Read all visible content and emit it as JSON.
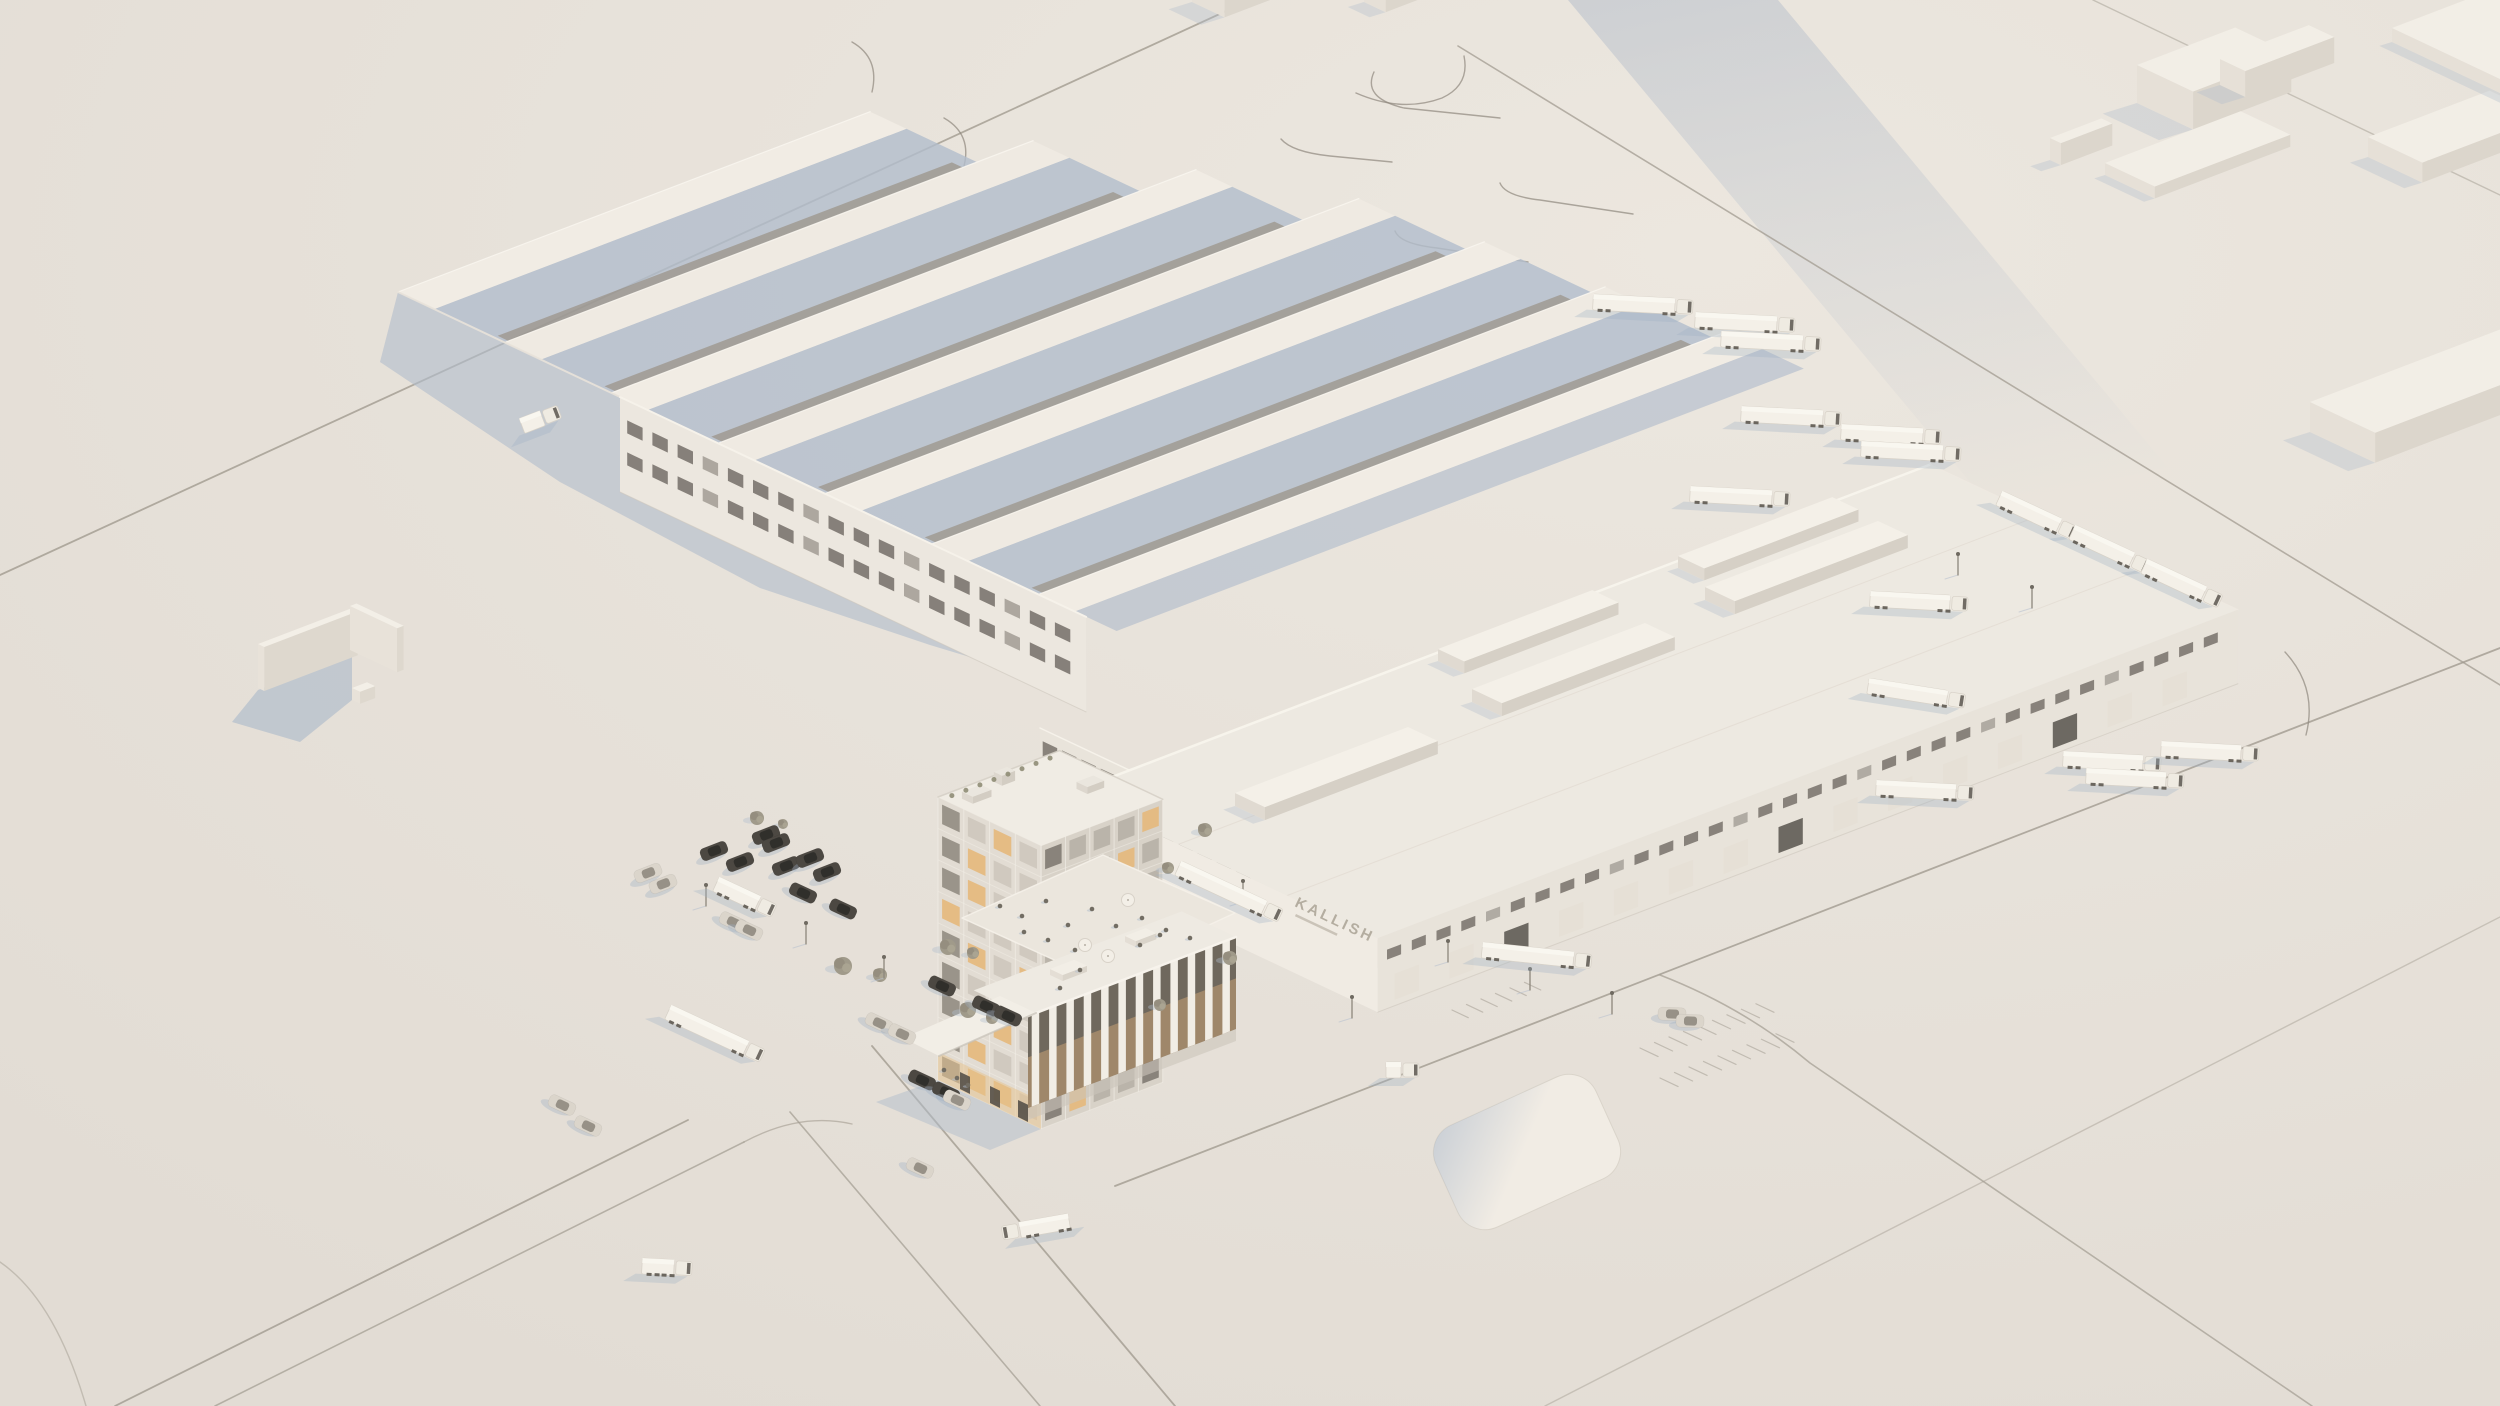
{
  "scene": {
    "signage": {
      "wall_text": "KALLISH"
    },
    "colors": {
      "ground_hi": "#ece7df",
      "ground_lo": "#e2dcd4",
      "roof_light": "#f1ece4",
      "roof_alt": "#efeae2",
      "roof_c": "#edE9e1",
      "face_light": "#efeae1",
      "face_mid": "#e6e0d7",
      "face_dark": "#dcd6cc",
      "shadow_blue": "#b2bdcc",
      "shadow_soft": "#c9c3b9",
      "window_dark": "#6d6760",
      "window_band": "#8f8471",
      "window_warm": "#e5b97f",
      "road": "#a19b90",
      "truck_white": "#f4f0e8",
      "car_dark": "#4c4842",
      "car_light": "#dbd5cb",
      "tree": "#a09a8a",
      "glow": "#e6c28c",
      "sign": "#b1aa9d"
    },
    "roads": [
      {
        "d": "M0,575 L1250,0",
        "w": 1.8,
        "o": 0.8
      },
      {
        "d": "M115,1406 L688,1120",
        "w": 1.8,
        "o": 0.8
      },
      {
        "d": "M215,1406 L744,1142",
        "w": 1.6,
        "o": 0.7
      },
      {
        "d": "M872,1046 L1175,1406",
        "w": 1.8,
        "o": 0.8
      },
      {
        "d": "M790,1112 L1040,1406",
        "w": 1.6,
        "o": 0.7
      },
      {
        "d": "M1115,1186 L2500,648",
        "w": 1.8,
        "o": 0.8
      },
      {
        "d": "M1545,1406 L2500,917",
        "w": 1.4,
        "o": 0.45
      },
      {
        "d": "M1660,975 Q1745,1008 1810,1063 L2312,1406",
        "w": 1.6,
        "o": 0.7
      },
      {
        "d": "M1458,46 L2500,685",
        "w": 1.6,
        "o": 0.75
      },
      {
        "d": "M2093,0 L2500,195",
        "w": 1.4,
        "o": 0.5
      },
      {
        "d": "M744,1142 Q800,1112 852,1124",
        "w": 1.4,
        "o": 0.6
      },
      {
        "d": "M0,1262 Q55,1300 86,1406",
        "w": 1.4,
        "o": 0.5
      }
    ],
    "lane_curves": [
      "M1374,72 Q1362,98 1404,108 L1500,118",
      "M1281,139 Q1292,152 1330,156 L1392,162",
      "M1500,183 Q1505,196 1540,200 L1633,214",
      "M1395,231 Q1400,244 1437,248 L1528,262",
      "M1637,297 Q1642,306 1676,312",
      "M1356,93 Q1402,113 1442,98 Q1470,85 1464,56",
      "M2285,652 Q2318,688 2306,735",
      "M852,42 Q880,58 872,92",
      "M944,118 Q972,134 964,166"
    ],
    "band_shadow": [
      [
        1568,
        0
      ],
      [
        1778,
        0
      ],
      [
        2245,
        560
      ],
      [
        2035,
        560
      ]
    ],
    "ground_shadows": [
      {
        "pts": [
          [
            398,
            292
          ],
          [
            1086,
            617
          ],
          [
            1086,
            692
          ],
          [
            930,
            645
          ],
          [
            760,
            588
          ],
          [
            560,
            482
          ],
          [
            380,
            362
          ]
        ],
        "c": "blue",
        "o": 0.62
      },
      {
        "pts": [
          [
            1070,
            795
          ],
          [
            1378,
            940
          ],
          [
            1378,
            968
          ],
          [
            1070,
            823
          ]
        ],
        "c": "soft",
        "o": 0.5
      }
    ],
    "stall_groups": [
      {
        "o": [
          1640,
          1048
        ],
        "n": 9,
        "step": 15.5,
        "len": 20
      },
      {
        "o": [
          1660,
          1078
        ],
        "n": 9,
        "step": 15.5,
        "len": 20
      },
      {
        "o": [
          1452,
          1010
        ],
        "n": 6,
        "step": 15.5,
        "len": 18
      }
    ],
    "pad": {
      "cx": 1527,
      "cy": 1152,
      "w": 176,
      "h": 112,
      "rx": 30,
      "rot": -24.5
    },
    "monitor_bars": {
      "origin": [
        398,
        292
      ],
      "vstep": 118,
      "count": 7,
      "width": 40,
      "band": 12,
      "lengths": [
        505,
        565,
        625,
        685,
        705,
        720,
        735
      ]
    },
    "warehouse_b": {
      "facade": {
        "origin": [
          620,
          397
        ],
        "vlen": 515,
        "h": 95,
        "win_rows": [
          20,
          52
        ],
        "win_n": 18,
        "win_step": 27.8
      }
    },
    "mid_hall": {
      "origin": [
        1040,
        728
      ],
      "vlen": 235,
      "h": 88,
      "roof_depth": 45,
      "win_n": 11
    },
    "warehouse_c": {
      "w": [
        1070,
        793
      ],
      "ulen": 920,
      "vlen": 340,
      "facade_h": 74,
      "ridge_offsets": [
        120,
        240
      ],
      "skylights": [
        {
          "o": [
            1235,
            806
          ],
          "lu": 185,
          "lv": 33,
          "h": 13
        },
        {
          "o": [
            1472,
            702
          ],
          "lu": 185,
          "lv": 33,
          "h": 13
        },
        {
          "o": [
            1705,
            600
          ],
          "lu": 185,
          "lv": 33,
          "h": 13
        },
        {
          "o": [
            1438,
            661
          ],
          "lu": 165,
          "lv": 29,
          "h": 12
        },
        {
          "o": [
            1678,
            568
          ],
          "lu": 165,
          "lv": 29,
          "h": 12
        }
      ],
      "win_n": 34,
      "dock_n": 15,
      "dark_docks": [
        2,
        7,
        12
      ],
      "sign_rot": 25.2
    },
    "tower": {
      "a": [
        938,
        797
      ],
      "ulen": 130,
      "vlen": 114,
      "height": 283,
      "sw": {
        "cols": 4,
        "rows": 9,
        "lit": [
          2,
          5,
          9,
          12,
          17,
          19,
          22,
          26,
          29,
          33,
          34
        ]
      },
      "se": {
        "cols": 5,
        "rows": 9,
        "lit": [
          4,
          8,
          13,
          17,
          21,
          27,
          33,
          38,
          41
        ]
      },
      "shadow": [
        [
          938,
          1080
        ],
        [
          1041,
          1129
        ],
        [
          990,
          1150
        ],
        [
          876,
          1102
        ]
      ]
    },
    "terrace": {
      "pts": [
        [
          962,
          918
        ],
        [
          1103,
          855
        ],
        [
          1235,
          913
        ],
        [
          1094,
          978
        ]
      ]
    },
    "colonnade": {
      "a": [
        1028,
        1016
      ],
      "b": [
        1236,
        937
      ],
      "h": 92,
      "cols": 12,
      "roof_depth": 60
    },
    "canopy": {
      "pts": [
        [
          903,
          1038
        ],
        [
          1000,
          996
        ],
        [
          1036,
          1013
        ],
        [
          939,
          1056
        ]
      ]
    },
    "people": [
      [
        1000,
        906
      ],
      [
        1022,
        916
      ],
      [
        1046,
        901
      ],
      [
        1068,
        925
      ],
      [
        1092,
        909
      ],
      [
        1116,
        926
      ],
      [
        1142,
        918
      ],
      [
        1166,
        930
      ],
      [
        1190,
        938
      ],
      [
        1075,
        950
      ],
      [
        1048,
        940
      ],
      [
        1024,
        932
      ],
      [
        1080,
        970
      ],
      [
        1140,
        945
      ],
      [
        1160,
        935
      ],
      [
        1060,
        988
      ],
      [
        944,
        1070
      ],
      [
        957,
        1078
      ],
      [
        968,
        1085
      ]
    ],
    "umbrellas": [
      [
        1085,
        945
      ],
      [
        1128,
        900
      ],
      [
        1108,
        956
      ]
    ],
    "trees": [
      [
        843,
        966,
        9
      ],
      [
        880,
        975,
        7
      ],
      [
        948,
        947,
        8
      ],
      [
        973,
        953,
        6
      ],
      [
        968,
        1010,
        8
      ],
      [
        992,
        1018,
        6
      ],
      [
        757,
        818,
        7
      ],
      [
        783,
        824,
        5
      ],
      [
        1205,
        830,
        7
      ],
      [
        1168,
        868,
        6
      ],
      [
        1230,
        958,
        7
      ],
      [
        1160,
        1005,
        6
      ]
    ],
    "poles": [
      [
        706,
        906
      ],
      [
        806,
        944
      ],
      [
        884,
        978
      ],
      [
        1243,
        902
      ],
      [
        1448,
        962
      ],
      [
        1530,
        990
      ],
      [
        1612,
        1014
      ],
      [
        1958,
        575
      ],
      [
        2032,
        608
      ],
      [
        1352,
        1018
      ]
    ],
    "context_boxes": [
      [
        2137,
        103,
        105,
        62,
        38
      ],
      [
        2220,
        85,
        95,
        28,
        26
      ],
      [
        2050,
        160,
        55,
        12,
        22
      ],
      [
        2105,
        175,
        145,
        55,
        12
      ],
      [
        2368,
        157,
        130,
        60,
        20
      ],
      [
        2392,
        42,
        108,
        300,
        14
      ],
      [
        2310,
        432,
        205,
        72,
        30
      ],
      [
        1192,
        2,
        120,
        36,
        26
      ],
      [
        1364,
        2,
        72,
        24,
        18
      ]
    ],
    "left_walls": {
      "boxes": [
        [
          258,
          688,
          100,
          7,
          44
        ],
        [
          350,
          650,
          7,
          52,
          44
        ],
        [
          352,
          700,
          16,
          9,
          12
        ]
      ],
      "shadow": [
        [
          258,
          690
        ],
        [
          352,
          652
        ],
        [
          352,
          700
        ],
        [
          300,
          742
        ],
        [
          232,
          722
        ]
      ]
    },
    "trucks": [
      [
        1593,
        302,
        3,
        82,
        1
      ],
      [
        1695,
        320,
        3,
        82,
        1
      ],
      [
        1721,
        339,
        3,
        82,
        1
      ],
      [
        1741,
        414,
        3,
        82,
        1
      ],
      [
        1841,
        432,
        3,
        82,
        1
      ],
      [
        1861,
        449,
        3,
        82,
        1
      ],
      [
        1690,
        494,
        3,
        82,
        1
      ],
      [
        1870,
        599,
        3,
        80,
        1
      ],
      [
        1868,
        686,
        9,
        80,
        1
      ],
      [
        1876,
        788,
        3,
        80,
        1
      ],
      [
        2063,
        759,
        3,
        80,
        1
      ],
      [
        2086,
        776,
        3,
        80,
        1
      ],
      [
        2161,
        749,
        3,
        80,
        1
      ],
      [
        1999,
        498,
        25,
        66,
        1
      ],
      [
        2072,
        532,
        25,
        66,
        1
      ],
      [
        2144,
        566,
        25,
        66,
        1
      ],
      [
        1178,
        868,
        25,
        95,
        1
      ],
      [
        1482,
        950,
        6,
        92,
        1
      ],
      [
        1020,
        1230,
        -10,
        50,
        -1
      ],
      [
        668,
        1012,
        25,
        86,
        1
      ],
      [
        716,
        884,
        25,
        46,
        1
      ],
      [
        642,
        1266,
        3,
        32,
        1
      ],
      [
        522,
        426,
        -21,
        22,
        1
      ],
      [
        1386,
        1070,
        0,
        15,
        1
      ]
    ],
    "cars": [
      [
        714,
        851,
        -21,
        "d"
      ],
      [
        740,
        862,
        -21,
        "d"
      ],
      [
        766,
        835,
        -21,
        "d"
      ],
      [
        786,
        866,
        -21,
        "d"
      ],
      [
        810,
        858,
        -21,
        "d"
      ],
      [
        827,
        872,
        -21,
        "d"
      ],
      [
        776,
        843,
        -21,
        "d"
      ],
      [
        843,
        909,
        25,
        "d"
      ],
      [
        803,
        893,
        25,
        "d"
      ],
      [
        942,
        986,
        25,
        "d"
      ],
      [
        986,
        1006,
        25,
        "d"
      ],
      [
        1008,
        1016,
        25,
        "d"
      ],
      [
        922,
        1080,
        25,
        "d"
      ],
      [
        946,
        1092,
        25,
        "d"
      ],
      [
        648,
        873,
        -21,
        "l"
      ],
      [
        663,
        884,
        -21,
        "l"
      ],
      [
        733,
        922,
        25,
        "l"
      ],
      [
        749,
        930,
        25,
        "l"
      ],
      [
        879,
        1023,
        25,
        "l"
      ],
      [
        902,
        1034,
        25,
        "l"
      ],
      [
        1672,
        1014,
        2,
        "l"
      ],
      [
        1690,
        1021,
        2,
        "l"
      ],
      [
        957,
        1100,
        25,
        "l"
      ],
      [
        920,
        1168,
        25,
        "l"
      ],
      [
        562,
        1105,
        25,
        "l"
      ],
      [
        588,
        1126,
        25,
        "l"
      ]
    ]
  }
}
